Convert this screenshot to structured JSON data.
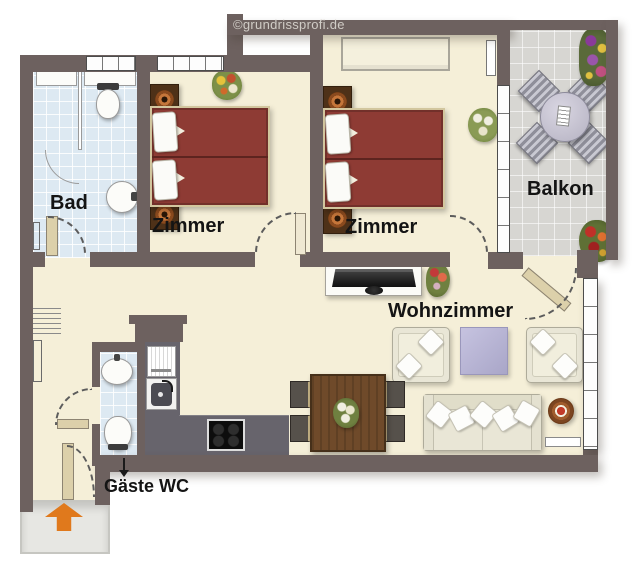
{
  "watermark": "©grundrissprofi.de",
  "rooms": {
    "bad": {
      "label": "Bad"
    },
    "zimmer1": {
      "label": "Zimmer"
    },
    "zimmer2": {
      "label": "Zimmer"
    },
    "balkon": {
      "label": "Balkon"
    },
    "wohnzimmer": {
      "label": "Wohnzimmer"
    },
    "gaeste_wc": {
      "label": "Gäste WC"
    }
  },
  "palette": {
    "wall": "#6d615f",
    "floor": "#f5efd8",
    "bath_tile": "#dde9f2",
    "balcony_tile": "#d7d6d2",
    "bed": "#8e3b34",
    "kitchen_counter": "#67646c",
    "entry_arrow": "#e0791c",
    "ottoman": "#b9b6d6",
    "wood_table": "#6f4a2a",
    "sofa": "#e9e6d6"
  },
  "icons": [
    "double-bed-icon",
    "nightstand-icon",
    "lamp-icon",
    "wardrobe-icon",
    "tv-icon",
    "sofa-icon",
    "armchair-icon",
    "ottoman-icon",
    "dining-table-icon",
    "dining-chair-icon",
    "side-table-icon",
    "kitchen-counter-icon",
    "cooktop-icon",
    "kitchen-sink-icon",
    "fridge-icon",
    "toilet-icon",
    "wash-basin-icon",
    "shower-icon",
    "balcony-table-icon",
    "balcony-chair-icon",
    "radiator-icon",
    "plant-icon",
    "flower-box-icon",
    "entry-arrow-icon",
    "door-swing-arc",
    "window-icon"
  ]
}
